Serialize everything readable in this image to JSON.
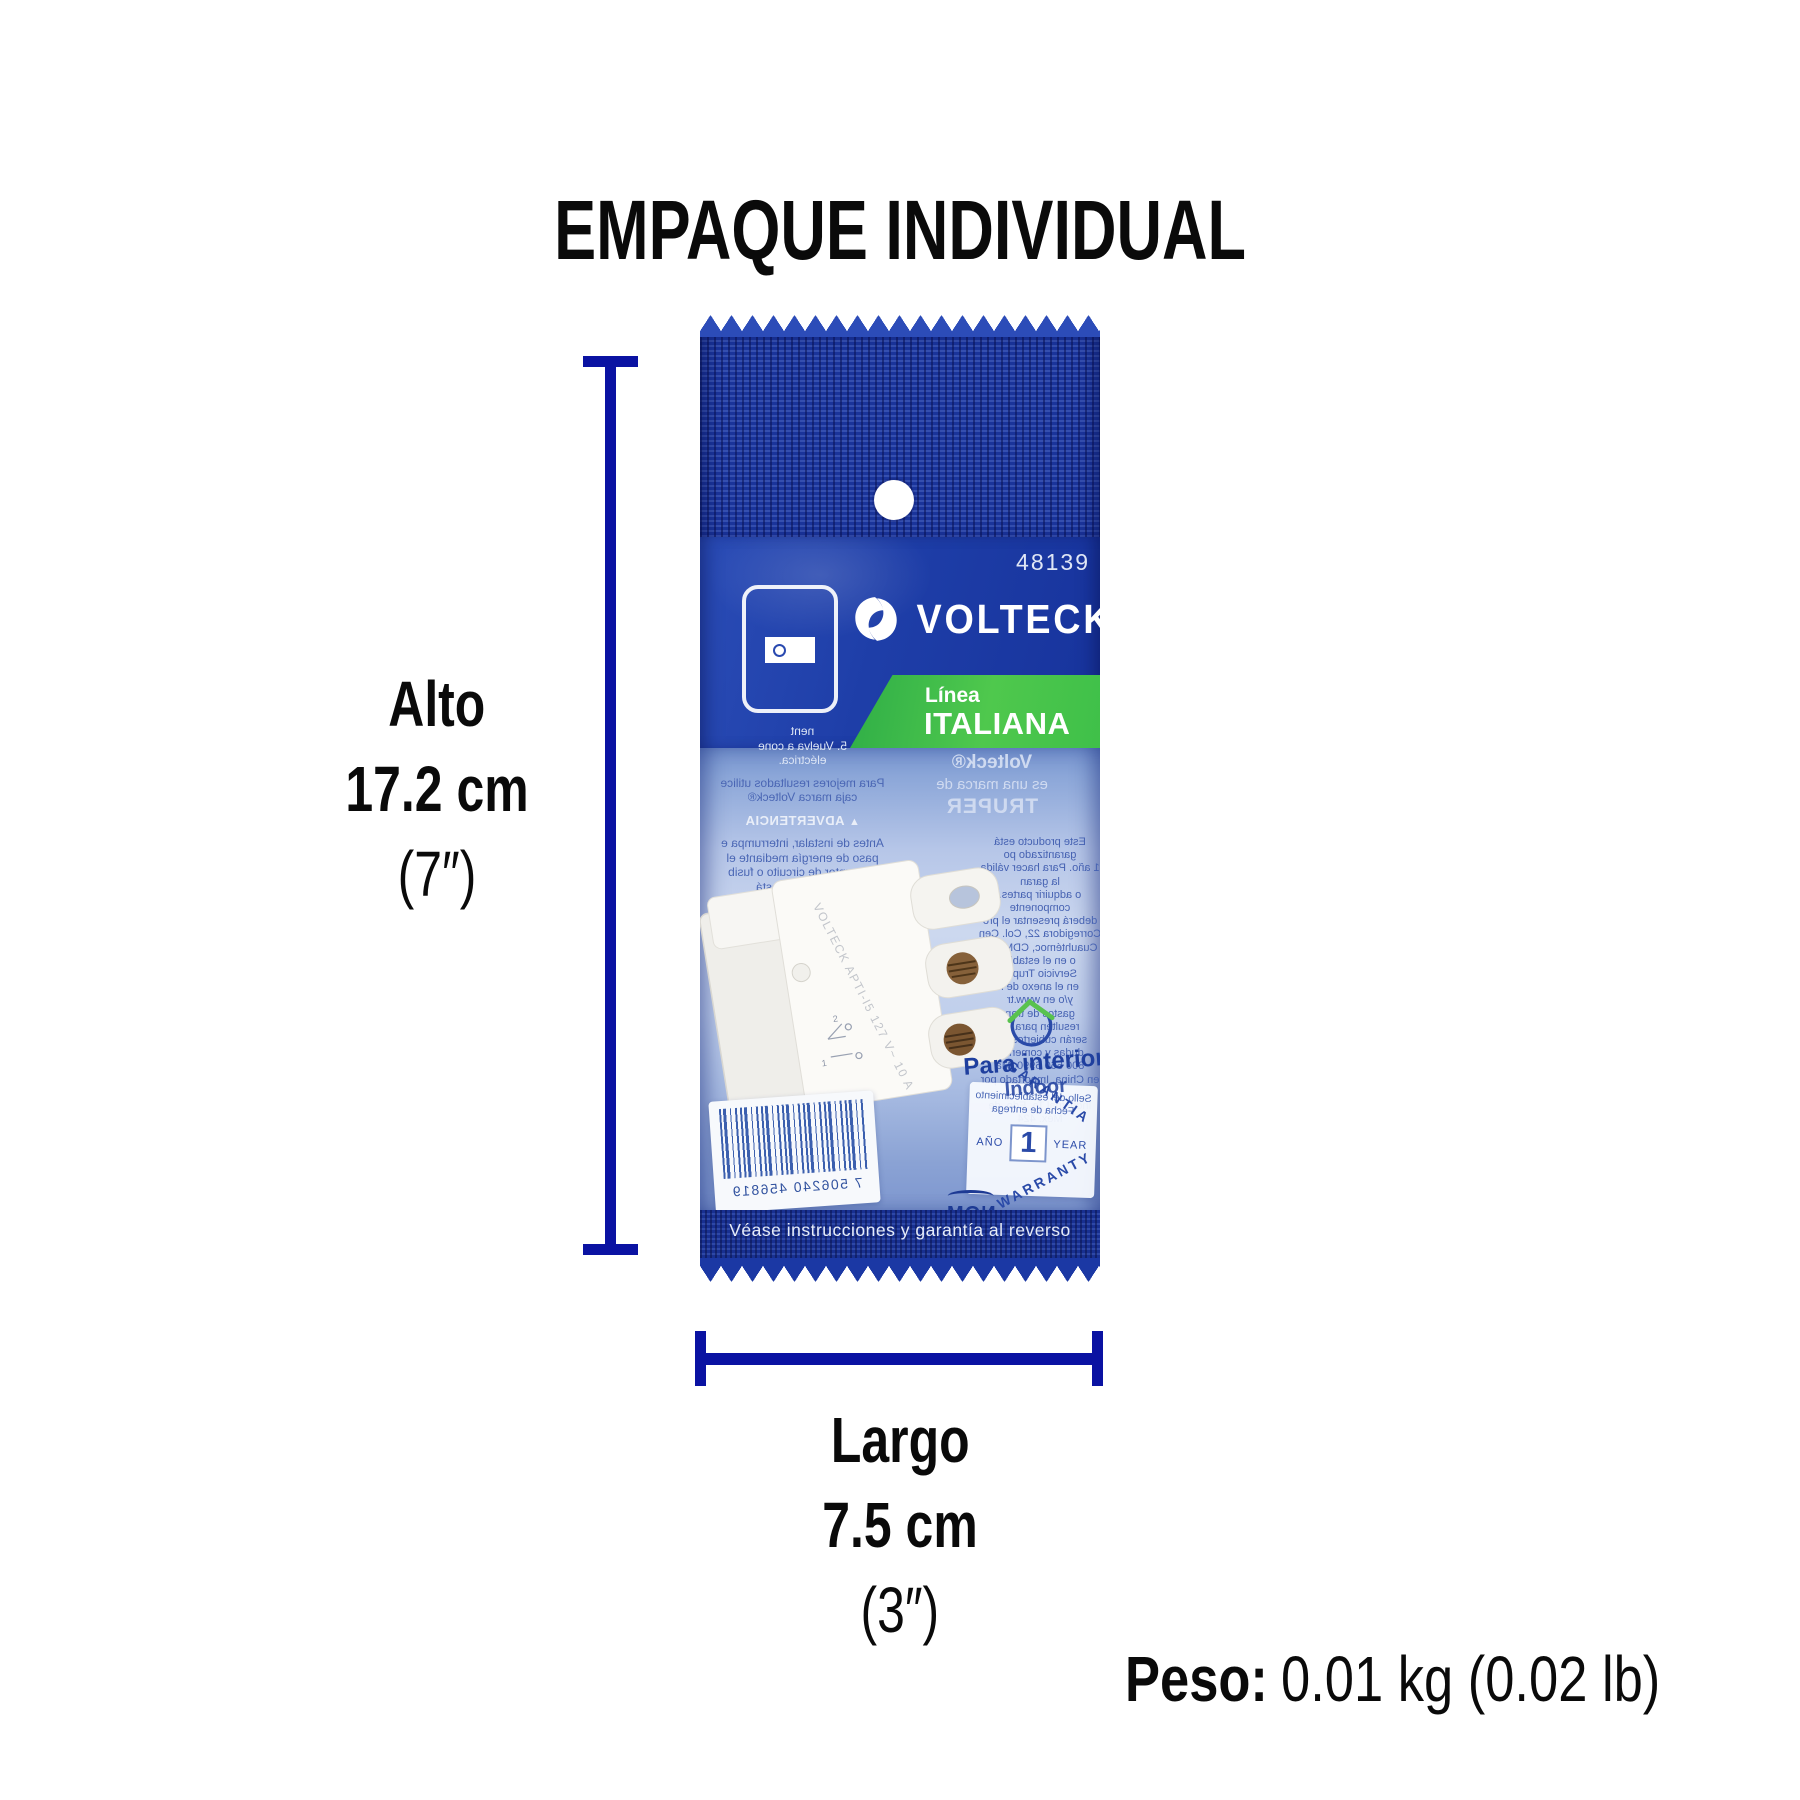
{
  "title": "EMPAQUE INDIVIDUAL",
  "dimensions": {
    "height": {
      "label": "Alto",
      "metric": "17.2 cm",
      "imperial": "(7″)"
    },
    "length": {
      "label": "Largo",
      "metric": "7.5 cm",
      "imperial": "(3″)"
    },
    "weight": {
      "label": "Peso:",
      "value": "0.01 kg (0.02 lb)"
    }
  },
  "colors": {
    "dimension_line": "#0a12a2",
    "package_navy": "#1e3ea8",
    "banner_green": "#44c24b",
    "window_blue": "#a9bce2",
    "title_black": "#0a0a0a"
  },
  "package": {
    "sku": "48139",
    "brand": "VOLTECK",
    "reg_mark": "®",
    "line": {
      "small": "Línea",
      "big": "ITALIANA"
    },
    "brand_back": {
      "line1": "Volteck®",
      "line2": "es una marca de",
      "line3": "TRUPER"
    },
    "back_text": {
      "light_lines": [
        "nent",
        "5.  Vuelva a cone",
        "eléctrica."
      ],
      "tip_lines": [
        "Para mejores resultados utilice",
        "caja marca Volteck®"
      ],
      "warning": "ADVERTENCIA",
      "es_lines": [
        "Antes de instalar, interrumpa e",
        "paso de energía mediante el",
        "nterruptor de circuito o fusib",
        "el circuito no está",
        "que el área está libre",
        "to. Si sobrepasa la",
        "ería. Mantenga la",
        "fuera del alcance",
        "s para prevenir",
        "de asfixia."
      ],
      "en_lines": [
        "interrupt the",
        "through the",
        "e. Make sure",
        "or registered",
        "ly. Do no",
        "uage of",
        "ddenda at",
        "cation."
      ],
      "right_lines": [
        "Este producto está garantizado po",
        "1 año. Para hacer válida la garan",
        "o adquirir partes, componente",
        "deberá presentar el pro",
        "Corregidora 22, Col. Cen",
        "Cuauhtémoc, CDMX, C",
        "o en el estable",
        "Servicio Truper",
        "en el anexo de l",
        "y/o en www.tr",
        "gastos de tran",
        "resulten para su",
        "serán cubiertos por",
        "dudas y comentar",
        "800 560 6990. Ma",
        "en China. Importado por Truper",
        "Industrial Ta, Edo. de Méx. 424"
      ]
    },
    "indoor": {
      "line1": "Para interior",
      "line2": "Indoor"
    },
    "product_marking": "VOLTECK  APTI-I5  127 V~  10 A",
    "diagram_labels": [
      "1",
      "2"
    ],
    "barcode_digits": "7 506240 456819",
    "warranty": {
      "seal_line1": "Sello del establecimiento",
      "seal_line2": "Fecha de entrega",
      "year_label_left": "AÑO",
      "year_value": "1",
      "year_label_right": "YEAR",
      "arc_top": "GARANTIA",
      "arc_bottom": "WARRANTY"
    },
    "nom": "NOM",
    "bottom_note": "Véase instrucciones y garantía al reverso"
  }
}
